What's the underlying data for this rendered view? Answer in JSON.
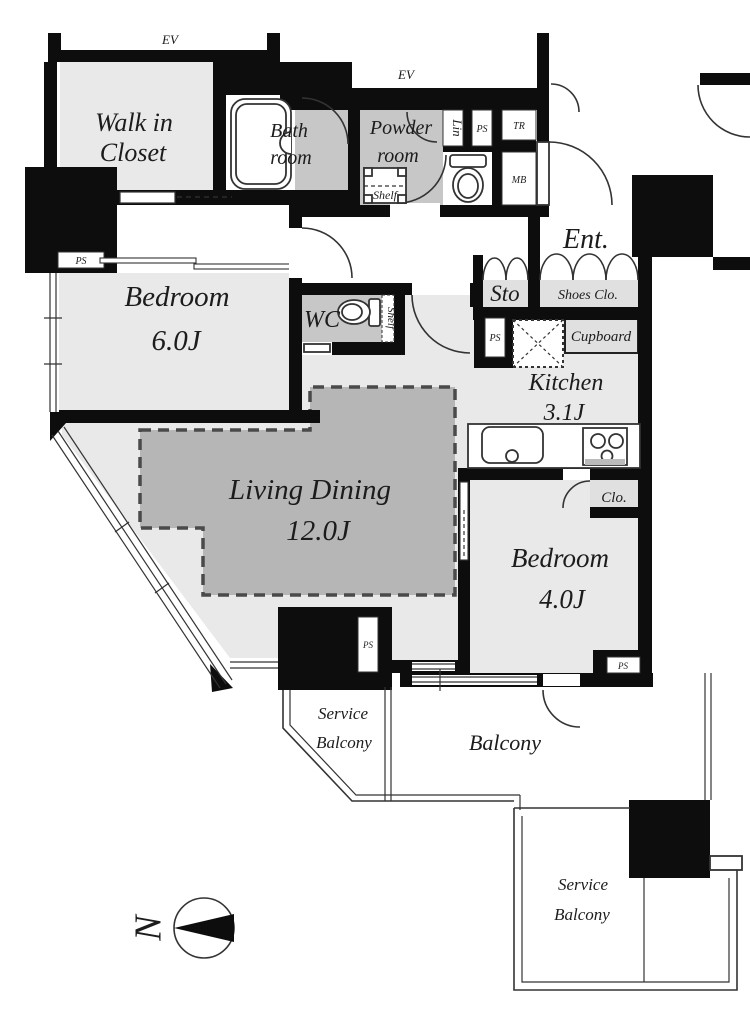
{
  "floor_plan": {
    "elevator_labels": [
      "EV",
      "EV"
    ],
    "rooms": {
      "walk_in_closet": {
        "line1": "Walk in",
        "line2": "Closet"
      },
      "bathroom": {
        "line1": "Bath",
        "line2": "room"
      },
      "powder_room": {
        "line1": "Powder",
        "line2": "room"
      },
      "bedroom_main": {
        "name": "Bedroom",
        "size": "6.0J"
      },
      "wc": {
        "label": "WC"
      },
      "entrance": {
        "label": "Ent."
      },
      "storage": {
        "label": "Sto"
      },
      "shoes_closet": {
        "label": "Shoes Clo."
      },
      "kitchen": {
        "name": "Kitchen",
        "size": "3.1J"
      },
      "living_dining": {
        "name": "Living Dining",
        "size": "12.0J"
      },
      "bedroom_second": {
        "name": "Bedroom",
        "size": "4.0J"
      },
      "closet": {
        "label": "Clo."
      },
      "cupboard": {
        "label": "Cupboard"
      },
      "service_balcony_west": {
        "line1": "Service",
        "line2": "Balcony"
      },
      "balcony": {
        "label": "Balcony"
      },
      "service_balcony_south": {
        "line1": "Service",
        "line2": "Balcony"
      }
    },
    "utility_labels": {
      "lin": "Lin",
      "tr": "TR",
      "mb": "MB",
      "shelf_powder": "Shelf",
      "shelf_wc": "Shelf"
    },
    "ps_labels": [
      "PS",
      "PS",
      "PS",
      "PS",
      "PS"
    ],
    "compass": {
      "north": "N"
    },
    "colors": {
      "wall": "#0d0d0d",
      "room": "#e9e9e9",
      "wet": "#c7c7c7",
      "dining": "#b6b6b6",
      "closet": "#e0e0e0",
      "line": "#333333"
    }
  }
}
